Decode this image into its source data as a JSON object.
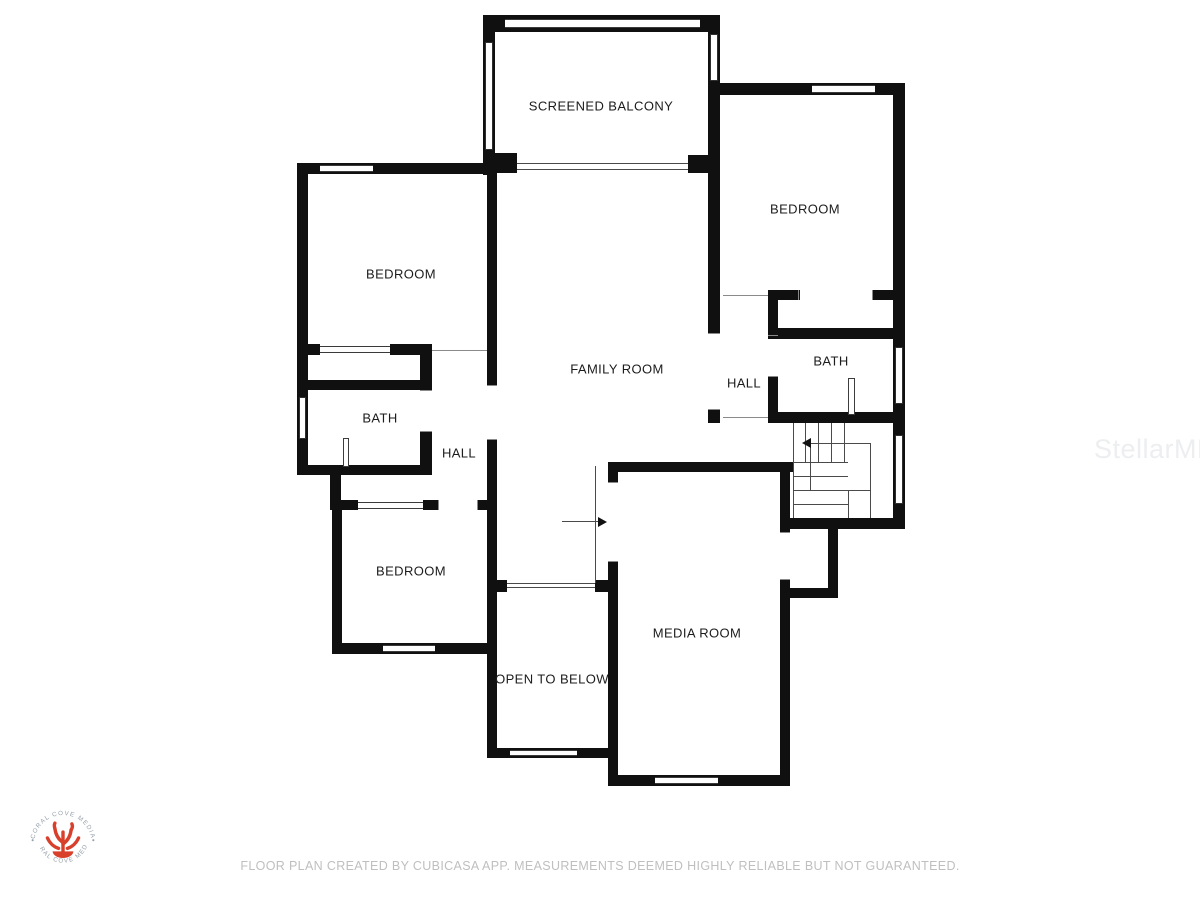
{
  "floorplan": {
    "wall_color": "#101010",
    "rooms": [
      {
        "id": "screened-balcony",
        "label": "SCREENED BALCONY"
      },
      {
        "id": "bedroom-ne",
        "label": "BEDROOM"
      },
      {
        "id": "bedroom-w",
        "label": "BEDROOM"
      },
      {
        "id": "family-room",
        "label": "FAMILY ROOM"
      },
      {
        "id": "hall-e",
        "label": "HALL"
      },
      {
        "id": "bath-e",
        "label": "BATH"
      },
      {
        "id": "bath-w",
        "label": "BATH"
      },
      {
        "id": "hall-w",
        "label": "HALL"
      },
      {
        "id": "bedroom-sw",
        "label": "BEDROOM"
      },
      {
        "id": "open-to-below",
        "label": "OPEN TO BELOW"
      },
      {
        "id": "media-room",
        "label": "MEDIA ROOM"
      }
    ]
  },
  "watermark": {
    "text": "StellarMLS"
  },
  "footer": {
    "text": "FLOOR PLAN CREATED BY CUBICASA APP. MEASUREMENTS DEEMED HIGHLY RELIABLE BUT NOT GUARANTEED."
  },
  "logo": {
    "arc_text_top": "CORAL COVE MEDIA",
    "arc_text_bottom": "CORAL COVE MEDIA",
    "coral_color": "#d8402c",
    "text_color": "#97a0aa"
  }
}
